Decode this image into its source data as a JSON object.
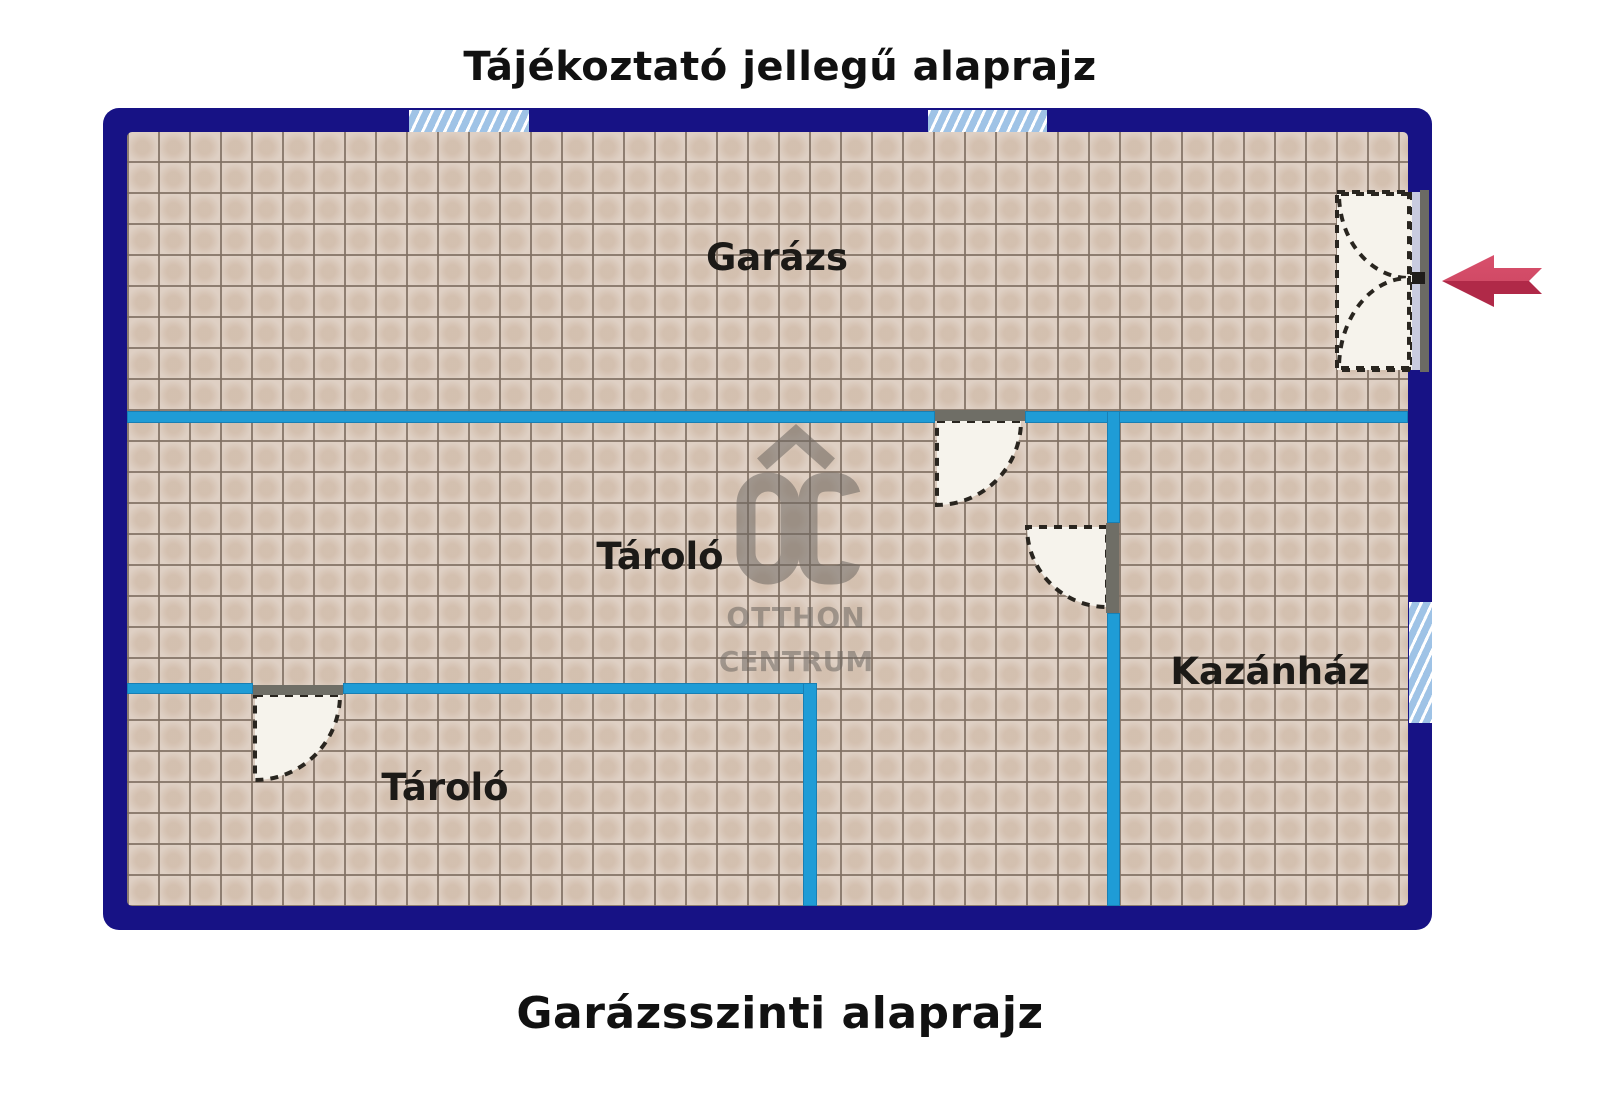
{
  "titles": {
    "top": "Tájékoztató jellegű alaprajz",
    "bottom": "Garázsszinti alaprajz"
  },
  "rooms": [
    {
      "label": "Garázs"
    },
    {
      "label": "Tároló"
    },
    {
      "label": "Kazánház"
    },
    {
      "label": "Tároló"
    }
  ],
  "logo": {
    "monogram": "OC",
    "line1": "OTTHON",
    "line2": "CENTRUM"
  },
  "colors": {
    "outer_wall_navy": "#171285",
    "interior_wall_cyan": "#1f9cd6",
    "tile_floor_beige": "#dccdc0",
    "tile_grout": "#80706 3",
    "window_hatch_blue": "#9fc3e6",
    "door_leaf_white": "#f6f3ec",
    "door_frame_gray": "#6f6e66",
    "entrance_arrow_red": "#d14a66",
    "entrance_arrow_red_dark": "#b02948",
    "logo_gray": "#6e6862",
    "title_text": "#111111"
  }
}
